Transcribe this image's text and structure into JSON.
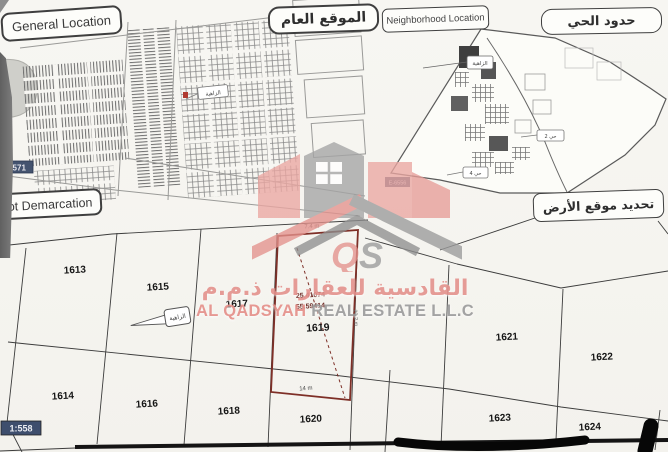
{
  "panels": {
    "general_location": {
      "title_en": "General Location",
      "title_ar": "الموقع العام",
      "road_badge": "5571",
      "street_label": "الزاهية"
    },
    "neighborhood": {
      "title_en": "Neighborhood Location",
      "title_ar": "حدود الحي",
      "badge": "E-6556",
      "area_label": "الزاهية",
      "sector_label_1": "حي 2",
      "sector_label_2": "حي 4"
    },
    "plot_map": {
      "title_en": "Plot Demarcation",
      "title_ar": "تحديد موقع الأرض",
      "scale": "1:558",
      "street_label": "الزاهية",
      "plots": [
        "1613",
        "1615",
        "1617",
        "1614",
        "1616",
        "1618",
        "1620",
        "1621",
        "1622",
        "1623",
        "1624"
      ],
      "target_plot": {
        "number": "1619",
        "latitude": "25.41074",
        "longitude": "55.59414",
        "dim_top": "7.4 m",
        "dim_bottom": "14 m",
        "dim_side": "20.2 m"
      }
    }
  },
  "watermark": {
    "logo_letter_1": "Q",
    "logo_letter_2": "S",
    "company_ar": "القادسية للعقارات ذ.م.م",
    "company_en_1": "AL QADSYAH",
    "company_en_2": "REAL ESTATE L.L.C"
  },
  "colors": {
    "brand_pink": "#e4928d",
    "brand_gray": "#9b9b9b",
    "plot_boundary_red": "#7e2f27",
    "badge_navy": "#44536f"
  }
}
